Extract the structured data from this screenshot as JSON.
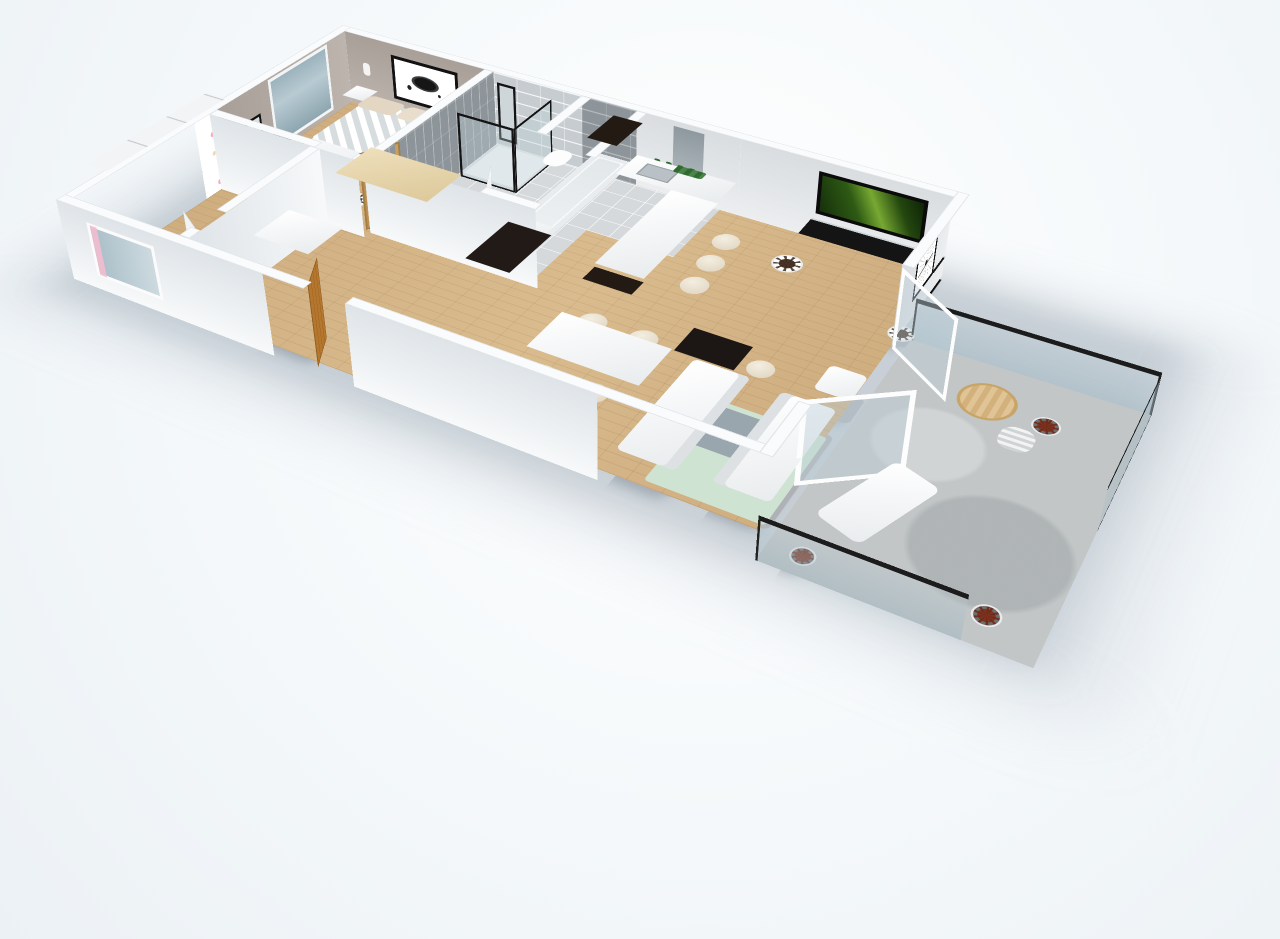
{
  "scene": {
    "type": "3d-floorplan-render",
    "view": "isometric-perspective-top",
    "rooms": [
      "bedroom",
      "kids-room",
      "bathroom",
      "hallway",
      "kitchen",
      "dining-area",
      "living-room",
      "balcony"
    ]
  },
  "colors": {
    "bgHi": "#ffffff",
    "bgMid": "#f4f8fa",
    "bgLo": "#ecf1f5",
    "wallTop": "#fafbfc",
    "wallGreige": "#bdb4ae",
    "wallLight": "#eceef0",
    "tileLightWall": "#c6ccd0",
    "tileDarkWall": "#8d959a",
    "tileFloor": "#d5d9db",
    "wood": "#cfae80",
    "concrete": "#c2c6c7",
    "espresso": "#241a14",
    "doorWood": "#b5772e",
    "pink": "#f6bcd0",
    "mint": "#cfe3d2",
    "cream": "#ddd2bd",
    "railFrame": "#1c1c1c",
    "tvForestA": "#16300b",
    "tvForestB": "#77a832",
    "plantRust": "#7c3420",
    "laptopGreen": "#3f7d1f"
  },
  "furniture": {
    "bedroom": [
      "double-bed-chevron-duvet",
      "nightstand-left",
      "nightstand-right",
      "desk-with-laptop",
      "stool",
      "potted-plant",
      "abstract-ink-art",
      "wall-mirror",
      "window-door"
    ],
    "kids_room": [
      "sliding-wardrobe",
      "crib-pink",
      "changing-table",
      "pink-rug",
      "potted-plant",
      "window-with-curtains"
    ],
    "bathroom": [
      "shower-glass-black-frame",
      "toilet",
      "sink-vanity",
      "bathtub"
    ],
    "hallway": [
      "built-in-wardrobe-wood",
      "white-tall-cabinet",
      "black-tall-cabinet",
      "entry-door-wood"
    ],
    "kitchen": [
      "back-counter-espresso",
      "peninsula-bar-white",
      "kitchen-sink",
      "range-hood",
      "shelf-with-bottles",
      "tall-column-espresso",
      "bar-stools-x3",
      "herb-box"
    ],
    "living_dining": [
      "dining-table-white",
      "dining-chairs-x4",
      "black-desk",
      "desk-chair",
      "tv-forest-screen",
      "tv-console-black",
      "sofa-white-x2",
      "armchair-white",
      "coffee-table-gray",
      "mint-rug",
      "dandelion-art",
      "potted-plants"
    ],
    "balcony": [
      "glass-railing-black-cap",
      "round-wood-table",
      "striped-chair",
      "white-lounger",
      "rust-plants-x3",
      "folding-glass-doors"
    ]
  }
}
